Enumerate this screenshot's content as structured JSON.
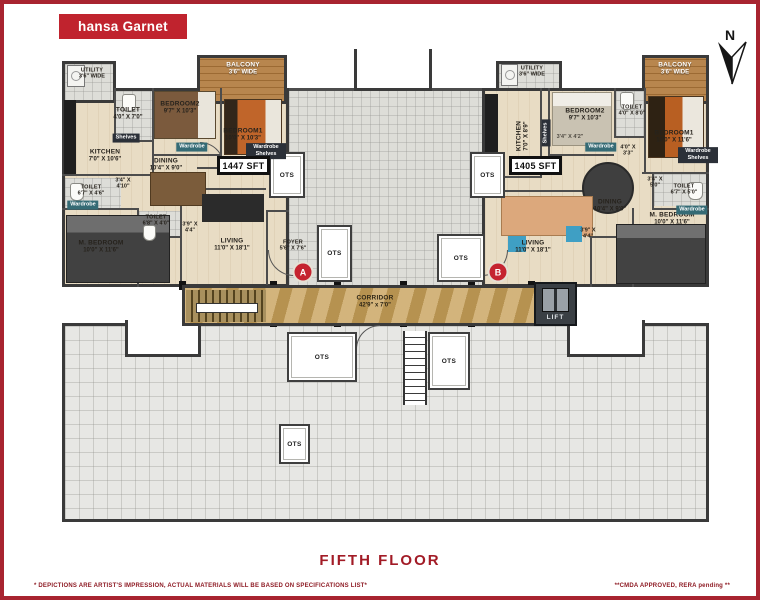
{
  "header": {
    "logo_text": "hansa Garnet",
    "compass_label": "N"
  },
  "footer": {
    "floor_title": "FIFTH FLOOR",
    "disclaimer": "* DEPICTIONS ARE ARTIST'S IMPRESSION, ACTUAL MATERIALS WILL BE BASED ON SPECIFICATIONS LIST*",
    "approval": "**CMDA APPROVED, RERA pending **"
  },
  "colors": {
    "brand_red": "#c0232e",
    "wall_dark": "#3a3a3a",
    "room_beige": "#e8dcc4",
    "terrace_gray": "#e7e7e4",
    "corridor_marble": "#c9a45f",
    "balcony_wood": "#b8864e",
    "badge_red": "#c52330"
  },
  "common": {
    "ots_label": "OTS",
    "lift_label": "LIFT",
    "corridor": {
      "name": "CORRIDOR",
      "dim": "42'9\" x 7'0\""
    }
  },
  "unit_a": {
    "badge": "A",
    "area": "1447 SFT",
    "rooms": {
      "utility": {
        "name": "UTILITY",
        "dim": "3'6\" WIDE"
      },
      "toilet_top": {
        "name": "TOILET",
        "dim": "4'0\" X 7'0\""
      },
      "bedroom2": {
        "name": "BEDROOM2",
        "dim": "9'7\" X 10'3\""
      },
      "kitchen": {
        "name": "KITCHEN",
        "dim": "7'0\" X 10'6\""
      },
      "dining": {
        "name": "DINING",
        "dim": "10'4\" X 9'0\""
      },
      "passage1": {
        "dim": "3'4\" X 4'10\""
      },
      "toilet_left": {
        "name": "TOILET",
        "dim": "6'7\" X 4'6\""
      },
      "toilet_mid": {
        "name": "TOILET",
        "dim": "6'8\" X 4'0\""
      },
      "passage2": {
        "dim": "3'9\" X 4'4\""
      },
      "m_bedroom": {
        "name": "M. BEDROOM",
        "dim": "10'0\" X 11'6\""
      },
      "living": {
        "name": "LIVING",
        "dim": "11'0\" X 18'1\""
      },
      "foyer": {
        "name": "FOYER",
        "dim": "5'6\" X 7'6\""
      },
      "balcony": {
        "name": "BALCONY",
        "dim": "3'6\" WIDE"
      },
      "bedroom1": {
        "name": "BEDROOM1",
        "dim": "10'0\" X 10'3\""
      }
    },
    "tags": {
      "shelves": "Shelves",
      "wardrobe": "Wardrobe",
      "wardrobe_shelves": "Wardrobe Shelves"
    }
  },
  "unit_b": {
    "badge": "B",
    "area": "1405 SFT",
    "rooms": {
      "utility": {
        "name": "UTILITY",
        "dim": "3'6\" WIDE"
      },
      "kitchen": {
        "name": "KITCHEN",
        "dim": "7'0\" X 8'9\""
      },
      "bedroom2": {
        "name": "BEDROOM2",
        "dim": "9'7\" X 10'3\""
      },
      "toilet_top": {
        "name": "TOILET",
        "dim": "4'0\" X 8'0\""
      },
      "passage1": {
        "dim": "4'0\" X 3'3\""
      },
      "passage_small": {
        "dim": "3'4\" X 4'2\""
      },
      "dining": {
        "name": "DINING",
        "dim": "10'4\" X 9'0\""
      },
      "bedroom1": {
        "name": "BEDROOM1",
        "dim": "10'0\" X 11'6\""
      },
      "passage2": {
        "dim": "3'4\" X 5'0\""
      },
      "toilet_right": {
        "name": "TOILET",
        "dim": "6'7\" X 5'0\""
      },
      "m_bedroom": {
        "name": "M. BEDROOM",
        "dim": "10'0\" X 11'6\""
      },
      "passage3": {
        "dim": "3'9\" X 4'4\""
      },
      "living": {
        "name": "LIVING",
        "dim": "11'0\" X 18'1\""
      },
      "balcony": {
        "name": "BALCONY",
        "dim": "3'6\" WIDE"
      }
    },
    "tags": {
      "shelves": "Shelves",
      "wardrobe": "Wardrobe",
      "wardrobe_shelves": "Wardrobe Shelves"
    }
  }
}
